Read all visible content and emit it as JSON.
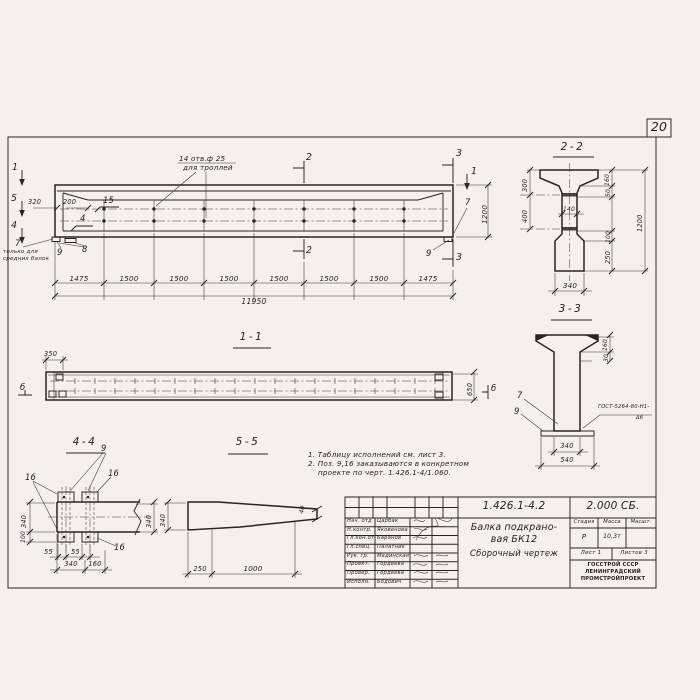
{
  "page": {
    "number": "20"
  },
  "elevation": {
    "holes_note": [
      "14 отв.ф 25",
      "для троллей"
    ],
    "markers": {
      "m1": "1",
      "m2": "2",
      "m3": "3",
      "m4": "4",
      "m5": "5"
    },
    "pos": {
      "p15": "15",
      "p4": "4",
      "p7": "7",
      "p8": "8",
      "p9": "9"
    },
    "note7": [
      "только для",
      "средних балок"
    ],
    "dim_320": "320",
    "dim_200": "200",
    "dim_1200": "1200",
    "segment_dims": [
      "1475",
      "1500",
      "1500",
      "1500",
      "1500",
      "1500",
      "1500",
      "1475"
    ],
    "total_dim": "11950"
  },
  "section22": {
    "title": "2-2",
    "dim_300": "300",
    "dim_400": "400",
    "dim_140": "140",
    "dim_160": "160",
    "dim_50": "50",
    "dim_1200": "1200",
    "dim_100": "100",
    "dim_250": "250",
    "dim_340": "340"
  },
  "section33": {
    "title": "3-3",
    "dim_160": "160",
    "dim_30": "30",
    "pos7": "7",
    "pos9": "9",
    "weld_note": [
      "ГОСТ-5264-80-Н1-",
      "Δ6"
    ],
    "dim_340": "340",
    "dim_540": "540"
  },
  "view11": {
    "title": "1-1",
    "dim_350": "350",
    "dim_650": "650",
    "marker_b": "б"
  },
  "view44": {
    "title": "4-4",
    "pos9": "9",
    "pos16": "16",
    "dim_340_left": "340",
    "dim_100": "100",
    "dim_55": "55",
    "dim_340_bottom": "340",
    "dim_160": "160",
    "dim_340_right": "340"
  },
  "view55": {
    "title": "5-5",
    "dim_340": "340",
    "dim_40": "40",
    "dim_250": "250",
    "dim_1000": "1000"
  },
  "notes": {
    "line1": "1. Таблицу исполнений см. лист 3.",
    "line2": "2. Поз. 9,16 заказываются в конкретном",
    "line3": "проекте по черт. 1.426.1-4/1.060."
  },
  "titleblock": {
    "doc_number": "1.426.1-4.2",
    "doc_code": "2.000 СБ.",
    "staff": [
      {
        "role": "Нач. отд",
        "name": "Царбак"
      },
      {
        "role": "Н.контр.",
        "name": "Яковенова"
      },
      {
        "role": "Гл.кон.от",
        "name": "Баранов"
      },
      {
        "role": "Гл.спец.",
        "name": "Палатник"
      },
      {
        "role": "Рук. гр.",
        "name": "Мединская"
      },
      {
        "role": "Проект.",
        "name": "Гордеева"
      },
      {
        "role": "Провер.",
        "name": "Гордеева"
      },
      {
        "role": "Исполн.",
        "name": "Бодович"
      }
    ],
    "title_lines": [
      "Балка подкрано-",
      "вая БК12",
      "Сборочный чертеж"
    ],
    "col_stage": "Стадия",
    "col_mass": "Масса",
    "col_scale": "Масшт.",
    "stage": "Р",
    "mass": "10,3т",
    "sheet": "Лист 1",
    "sheets": "Листов 3",
    "org": [
      "ГОССТРОЙ СССР",
      "ЛЕНИНГРАДСКИЙ",
      "ПРОМСТРОЙПРОЕКТ"
    ]
  }
}
